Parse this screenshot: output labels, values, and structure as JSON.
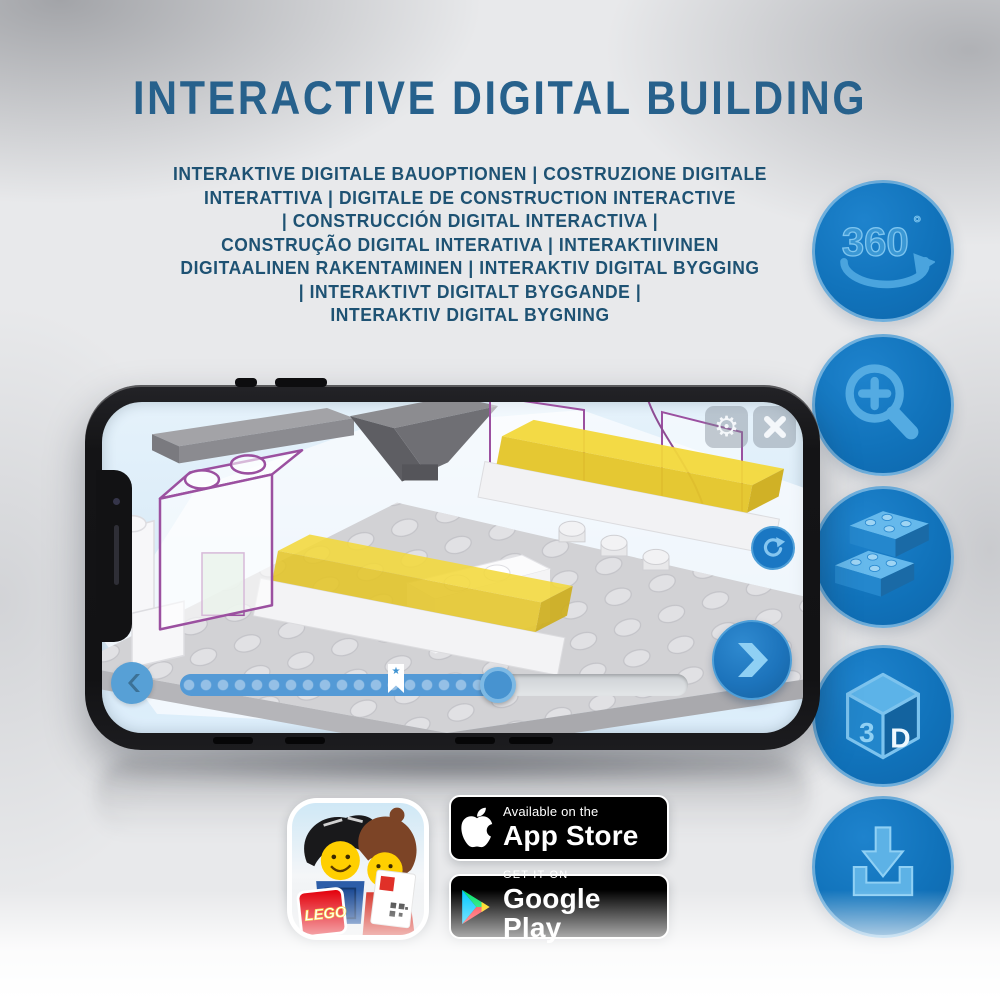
{
  "title": "INTERACTIVE DIGITAL BUILDING",
  "subtitle_lines": [
    "INTERAKTIVE DIGITALE BAUOPTIONEN | COSTRUZIONE DIGITALE",
    "INTERATTIVA | DIGITALE DE CONSTRUCTION INTERACTIVE",
    "| CONSTRUCCIÓN DIGITAL INTERACTIVA |",
    "CONSTRUÇÃO DIGITAL INTERATIVA | INTERAKTIIVINEN",
    "DIGITAALINEN RAKENTAMINEN | INTERAKTIV DIGITAL BYGGING",
    "| INTERAKTIVT DIGITALT BYGGANDE |",
    "INTERAKTIV DIGITAL BYGNING"
  ],
  "feature_icons": [
    {
      "name": "rotation-360-icon",
      "label": "360",
      "degree": "°"
    },
    {
      "name": "zoom-in-icon"
    },
    {
      "name": "bricks-icon"
    },
    {
      "name": "cube-3d-icon",
      "left": "3",
      "right": "D"
    },
    {
      "name": "download-icon"
    }
  ],
  "phone_app": {
    "progress_filled_percent": 63,
    "bookmark_position_percent": 42,
    "controls": [
      "settings",
      "close",
      "rotate",
      "previous",
      "next",
      "seek-handle"
    ]
  },
  "store_badges": {
    "lego_logo": "LEGO",
    "apple": {
      "line1": "Available on the",
      "line2": "App Store"
    },
    "google": {
      "line1": "GET IT ON",
      "line2": "Google Play"
    }
  },
  "colors": {
    "accent_blue": "#1276BE",
    "icon_light_blue": "#8FD0F4",
    "title_blue": "#27618C",
    "subtitle_navy": "#1E5273",
    "screen_blue": "#D8EAF7",
    "lego_yellow": "#F2D83B",
    "badge_black": "#000000"
  }
}
